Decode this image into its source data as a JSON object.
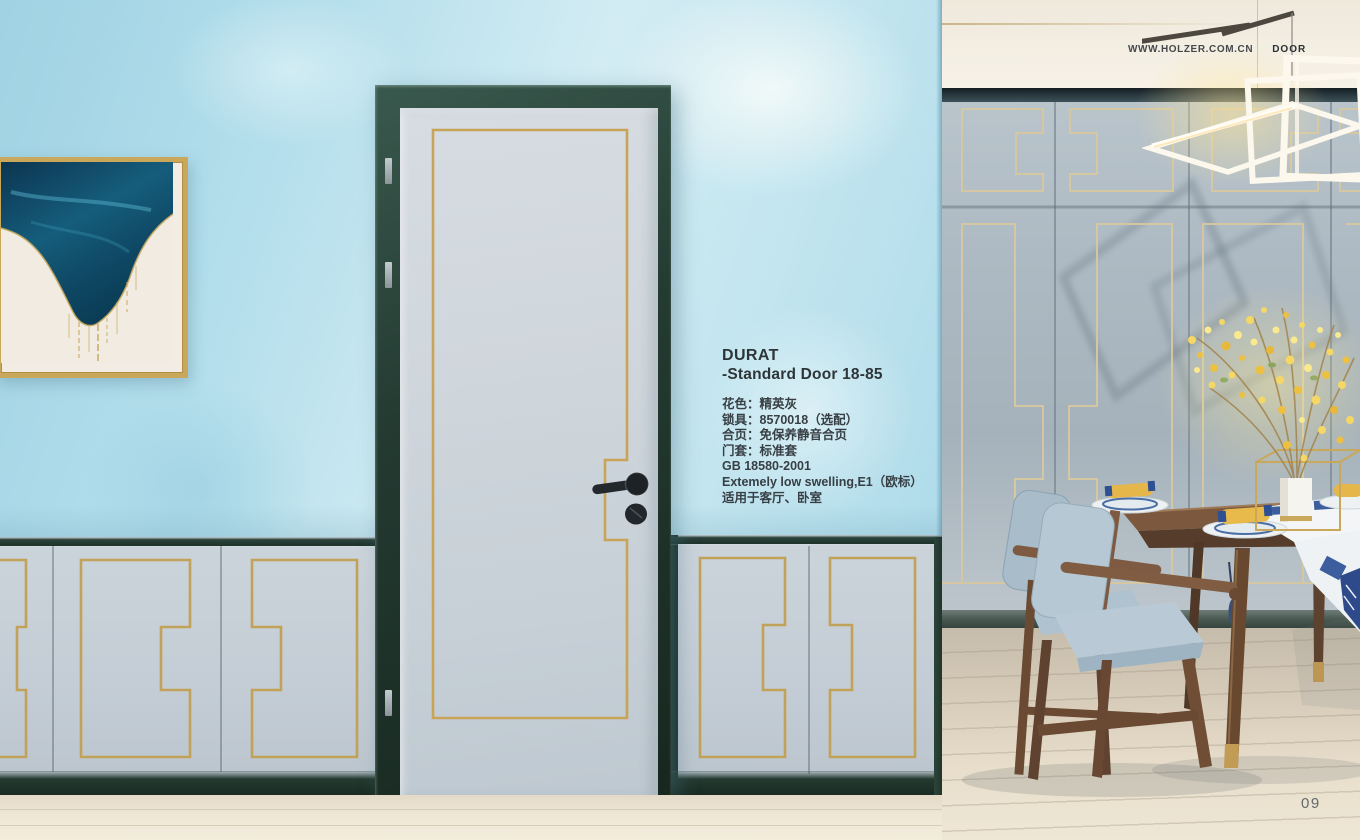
{
  "header": {
    "website": "WWW.HOLZER.COM.CN",
    "category": "DOOR"
  },
  "product": {
    "name": "DURAT",
    "series": "-Standard Door 18-85",
    "specs": [
      "花色：精英灰",
      "锁具：8570018（选配）",
      "合页：免保养静音合页",
      "门套：标准套",
      "GB 18580-2001",
      "Extemely low swelling,E1（欧标）",
      "适用于客厅、卧室"
    ]
  },
  "page_number": "09",
  "colors": {
    "wall_blue": "#aedcec",
    "frame_green": "#22382f",
    "gold_trim": "#c8a558",
    "door_panel": "#ccd4da",
    "panel_wall_gray": "#aab6c0",
    "wood": "#7a5740",
    "cushion_blue": "#b6c7d2",
    "flower_yellow": "#efc94d",
    "floor_wood": "#efe7d6"
  }
}
